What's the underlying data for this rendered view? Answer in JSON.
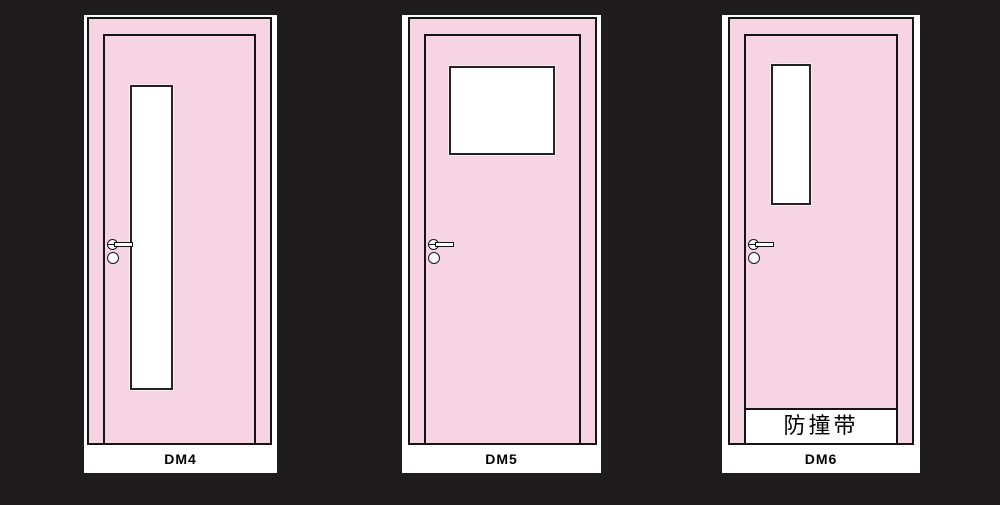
{
  "colors": {
    "background": "#1F1C1D",
    "door_pink": "#F7D4E3",
    "card_white": "#FFFFFF",
    "line_black": "#151515"
  },
  "doors": [
    {
      "label": "DM4",
      "glass": "tall narrow vertical glass panel",
      "handle": "lever handle with knob, left side"
    },
    {
      "label": "DM5",
      "glass": "square vision glass panel, top center",
      "handle": "lever handle with knob, left side"
    },
    {
      "label": "DM6",
      "glass": "narrow vertical glass panel, top left",
      "handle": "lever handle with knob, left side",
      "band_label": "防撞带"
    }
  ]
}
